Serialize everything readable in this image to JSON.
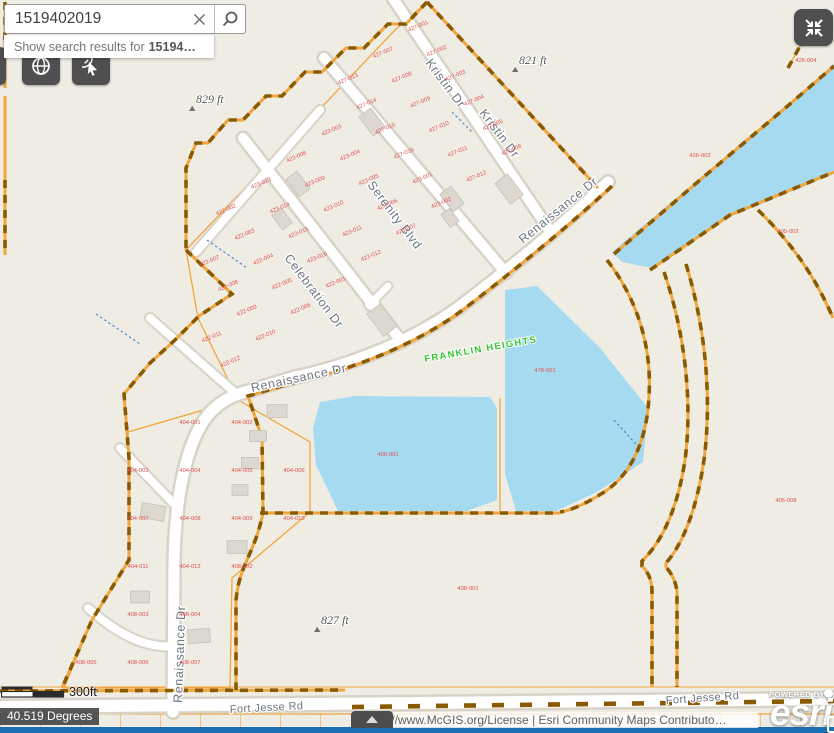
{
  "search": {
    "value": "1519402019",
    "placeholder": "",
    "suggestion_prefix": "Show search results for",
    "suggestion_term": "15194…"
  },
  "toolbar": {
    "basemap_button": "basemap-gallery",
    "identify_button": "identify-tool",
    "collapse_button": "collapse-panels"
  },
  "scalebar": {
    "label": "300ft"
  },
  "position": {
    "label": "40.519 Degrees"
  },
  "attribution": {
    "text": "http://www.McGIS.org/License | Esri Community Maps Contributo…",
    "powered_by": "POWERED BY",
    "brand": "esri"
  },
  "map": {
    "streets": {
      "kristin": "Kristin Dr",
      "serenity": "Serenity Blvd",
      "celebration": "Celebration Dr",
      "renaissance": "Renaissance Dr",
      "fort_jesse": "Fort Jesse Rd"
    },
    "subdivision_label": "FRANKLIN HEIGHTS",
    "elevation_markers": [
      {
        "text": "829 ft",
        "x": 196,
        "y": 103
      },
      {
        "text": "821 ft",
        "x": 519,
        "y": 64
      },
      {
        "text": "827 ft",
        "x": 321,
        "y": 624
      }
    ],
    "point_labels": [
      {
        "text": "406-001",
        "x": 388,
        "y": 456
      },
      {
        "text": "426-002",
        "x": 700,
        "y": 157
      },
      {
        "text": "478-001",
        "x": 545,
        "y": 372
      },
      {
        "text": "405-002",
        "x": 788,
        "y": 233
      },
      {
        "text": "405-008",
        "x": 786,
        "y": 502
      },
      {
        "text": "408-001",
        "x": 468,
        "y": 590
      },
      {
        "text": "426-004",
        "x": 806,
        "y": 62
      }
    ],
    "parcel_series": [
      "427-001",
      "427-002",
      "427-003",
      "427-004",
      "427-005",
      "427-006",
      "427-007",
      "427-008",
      "427-009",
      "427-010",
      "427-011",
      "427-012",
      "427-013",
      "427-014",
      "427-015",
      "427-016",
      "423-001",
      "423-002",
      "423-003",
      "423-004",
      "423-005",
      "423-006",
      "423-007",
      "423-008",
      "423-009",
      "423-010",
      "423-011",
      "423-012",
      "423-013",
      "423-014",
      "423-015",
      "423-016",
      "422-001",
      "422-002",
      "422-003",
      "422-004",
      "422-005",
      "422-006",
      "422-007",
      "422-008",
      "422-009",
      "422-010",
      "422-011",
      "422-012",
      "422-013",
      "422-014",
      "402-001",
      "402-002",
      "402-003",
      "402-004",
      "402-005",
      "402-006",
      "402-007",
      "402-008",
      "402-009",
      "402-010",
      "403-001",
      "403-002",
      "403-003",
      "403-004",
      "403-005",
      "403-006",
      "403-007",
      "403-008",
      "403-009",
      "403-010",
      "404-001",
      "404-002",
      "404-003",
      "404-004",
      "404-005",
      "404-006",
      "404-007",
      "404-008",
      "404-009",
      "404-010",
      "404-011",
      "404-012",
      "408-002",
      "408-003",
      "408-004",
      "408-005",
      "408-006",
      "408-007",
      "408-008",
      "408-009"
    ],
    "colors": {
      "background": "#efece4",
      "water": "#a6daf1",
      "parcel_line": "#f0a63c",
      "boundary_dash": "#8a5a00",
      "road_fill": "#ffffff",
      "parcel_text": "#e05050",
      "subdivision_text": "#35c435",
      "ui_blue": "#1d6fb4"
    }
  }
}
